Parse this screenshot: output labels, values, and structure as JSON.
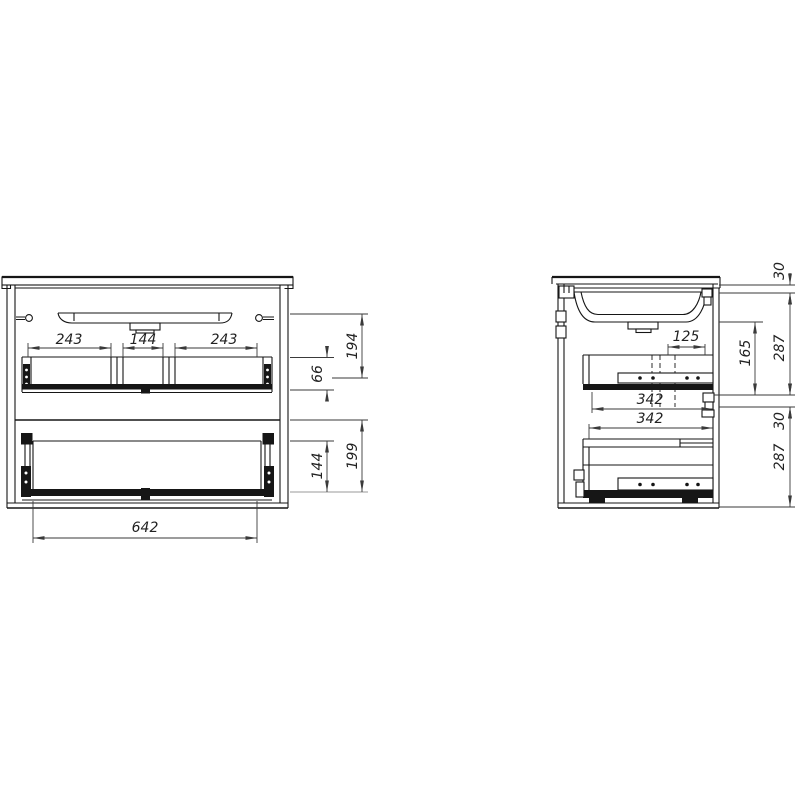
{
  "drawing": {
    "description": "Technical drawing of a wall-hung vanity cabinet with sink and two drawers, front view and side section view",
    "background_color": "#ffffff",
    "line_color": "#161616",
    "dimension_color": "#3a3a3a",
    "front": {
      "dims": {
        "compartment_left": "243",
        "compartment_middle": "144",
        "compartment_right": "243",
        "upper_section_height": "194",
        "upper_drawer_side_height": "66",
        "lower_section_height": "199",
        "lower_drawer_side_height": "144",
        "drawer_width": "642"
      }
    },
    "side": {
      "dims": {
        "countertop_thickness": "30",
        "upper_section_height": "287",
        "sink_to_drawer_clearance": "165",
        "front_inset": "125",
        "upper_drawer_depth": "342",
        "lower_drawer_depth": "342",
        "mid_gap": "30",
        "lower_section_height": "287"
      }
    }
  }
}
